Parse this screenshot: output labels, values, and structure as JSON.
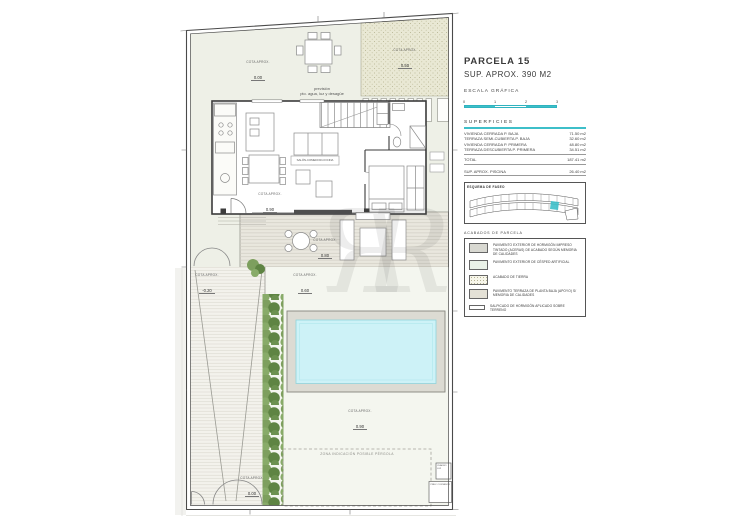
{
  "colors": {
    "accent_teal": "#3ebfc9",
    "pool_water": "#cdf2f7",
    "pool_deck": "#dcdbd3",
    "hedge_green": "#6c9150",
    "tierra_fill": "#e9e8d4",
    "terrace_fill": "#e9e7de",
    "line_dark": "#3b3b3b"
  },
  "watermark": {
    "letter": "R"
  },
  "plan": {
    "cota_label": "COTA APROX.",
    "cotas": [
      {
        "name": "front-terrain",
        "value": "0.00"
      },
      {
        "name": "tierra-area",
        "value": "0.50"
      },
      {
        "name": "house-floor",
        "value": "0.90"
      },
      {
        "name": "terrace",
        "value": "0.80"
      },
      {
        "name": "garden-mid",
        "value": "0.60"
      },
      {
        "name": "driveway",
        "value": "-0.20"
      },
      {
        "name": "lawn-south",
        "value": "0.90"
      },
      {
        "name": "entrance-gate",
        "value": "0.00"
      }
    ],
    "prevision_line1": "previsión",
    "prevision_line2": "pto. agua, luz y desagüe",
    "salon_label": "SALÓN-COMEDOR-COCINA",
    "pergola_note": "ZONA INDICACIÓN POSIBLE PÉRGOLA",
    "utility_box_top": "CUADRO LUZ",
    "utility_box_bottom": "PREV. CONTADOR"
  },
  "panel": {
    "parcel_title": "PARCELA 15",
    "parcel_area": "SUP. APROX. 390 M2",
    "scale_title": "ESCALA GRÁFICA",
    "scale_ticks": [
      "0",
      "1",
      "2",
      "3"
    ],
    "superficies_title": "SUPERFICIES",
    "superficies_rows": [
      {
        "label": "VIVIENDA CERRADA P. BAJA",
        "value": "71.50 m2"
      },
      {
        "label": "TERRAZA SEMI-CUBIERTA P. BAJA",
        "value": "32.60 m2"
      },
      {
        "label": "VIVIENDA CERRADA P. PRIMERA",
        "value": "48.80 m2"
      },
      {
        "label": "TERRAZA DESCUBIERTA P. PRIMERA",
        "value": "34.51 m2"
      }
    ],
    "total_row": {
      "label": "TOTAL",
      "value": "187.41 m2"
    },
    "pool_row": {
      "label": "SUP. APROX. PISCINA",
      "value": "26.40 m2"
    },
    "site_map_title": "ESQUEMA DE FASEO",
    "acabados_title": "ACABADOS DE PARCELA",
    "legend": [
      {
        "id": "hormigon-impreso",
        "text": "PAVIMENTO EXTERIOR DE HORMIGÓN IMPRESO TINTADO (ACERAS) DE ACABADO SEGÚN MEMORIA DE CALIDADES"
      },
      {
        "id": "cesped-artificial",
        "text": "PAVIMENTO EXTERIOR DE CÉSPED ARTIFICIAL"
      },
      {
        "id": "tierra",
        "text": "ACABADO DE TIERRA"
      },
      {
        "id": "pavimento-terraza",
        "text": "PAVIMENTO TERRAZA DE PLANTA BAJA (APOYO) S/ MEMORIA DE CALIDADES"
      },
      {
        "id": "salpicado",
        "text": "SALPICADO DE HORMIGÓN APLICADO SOBRE TERRENO"
      }
    ]
  }
}
